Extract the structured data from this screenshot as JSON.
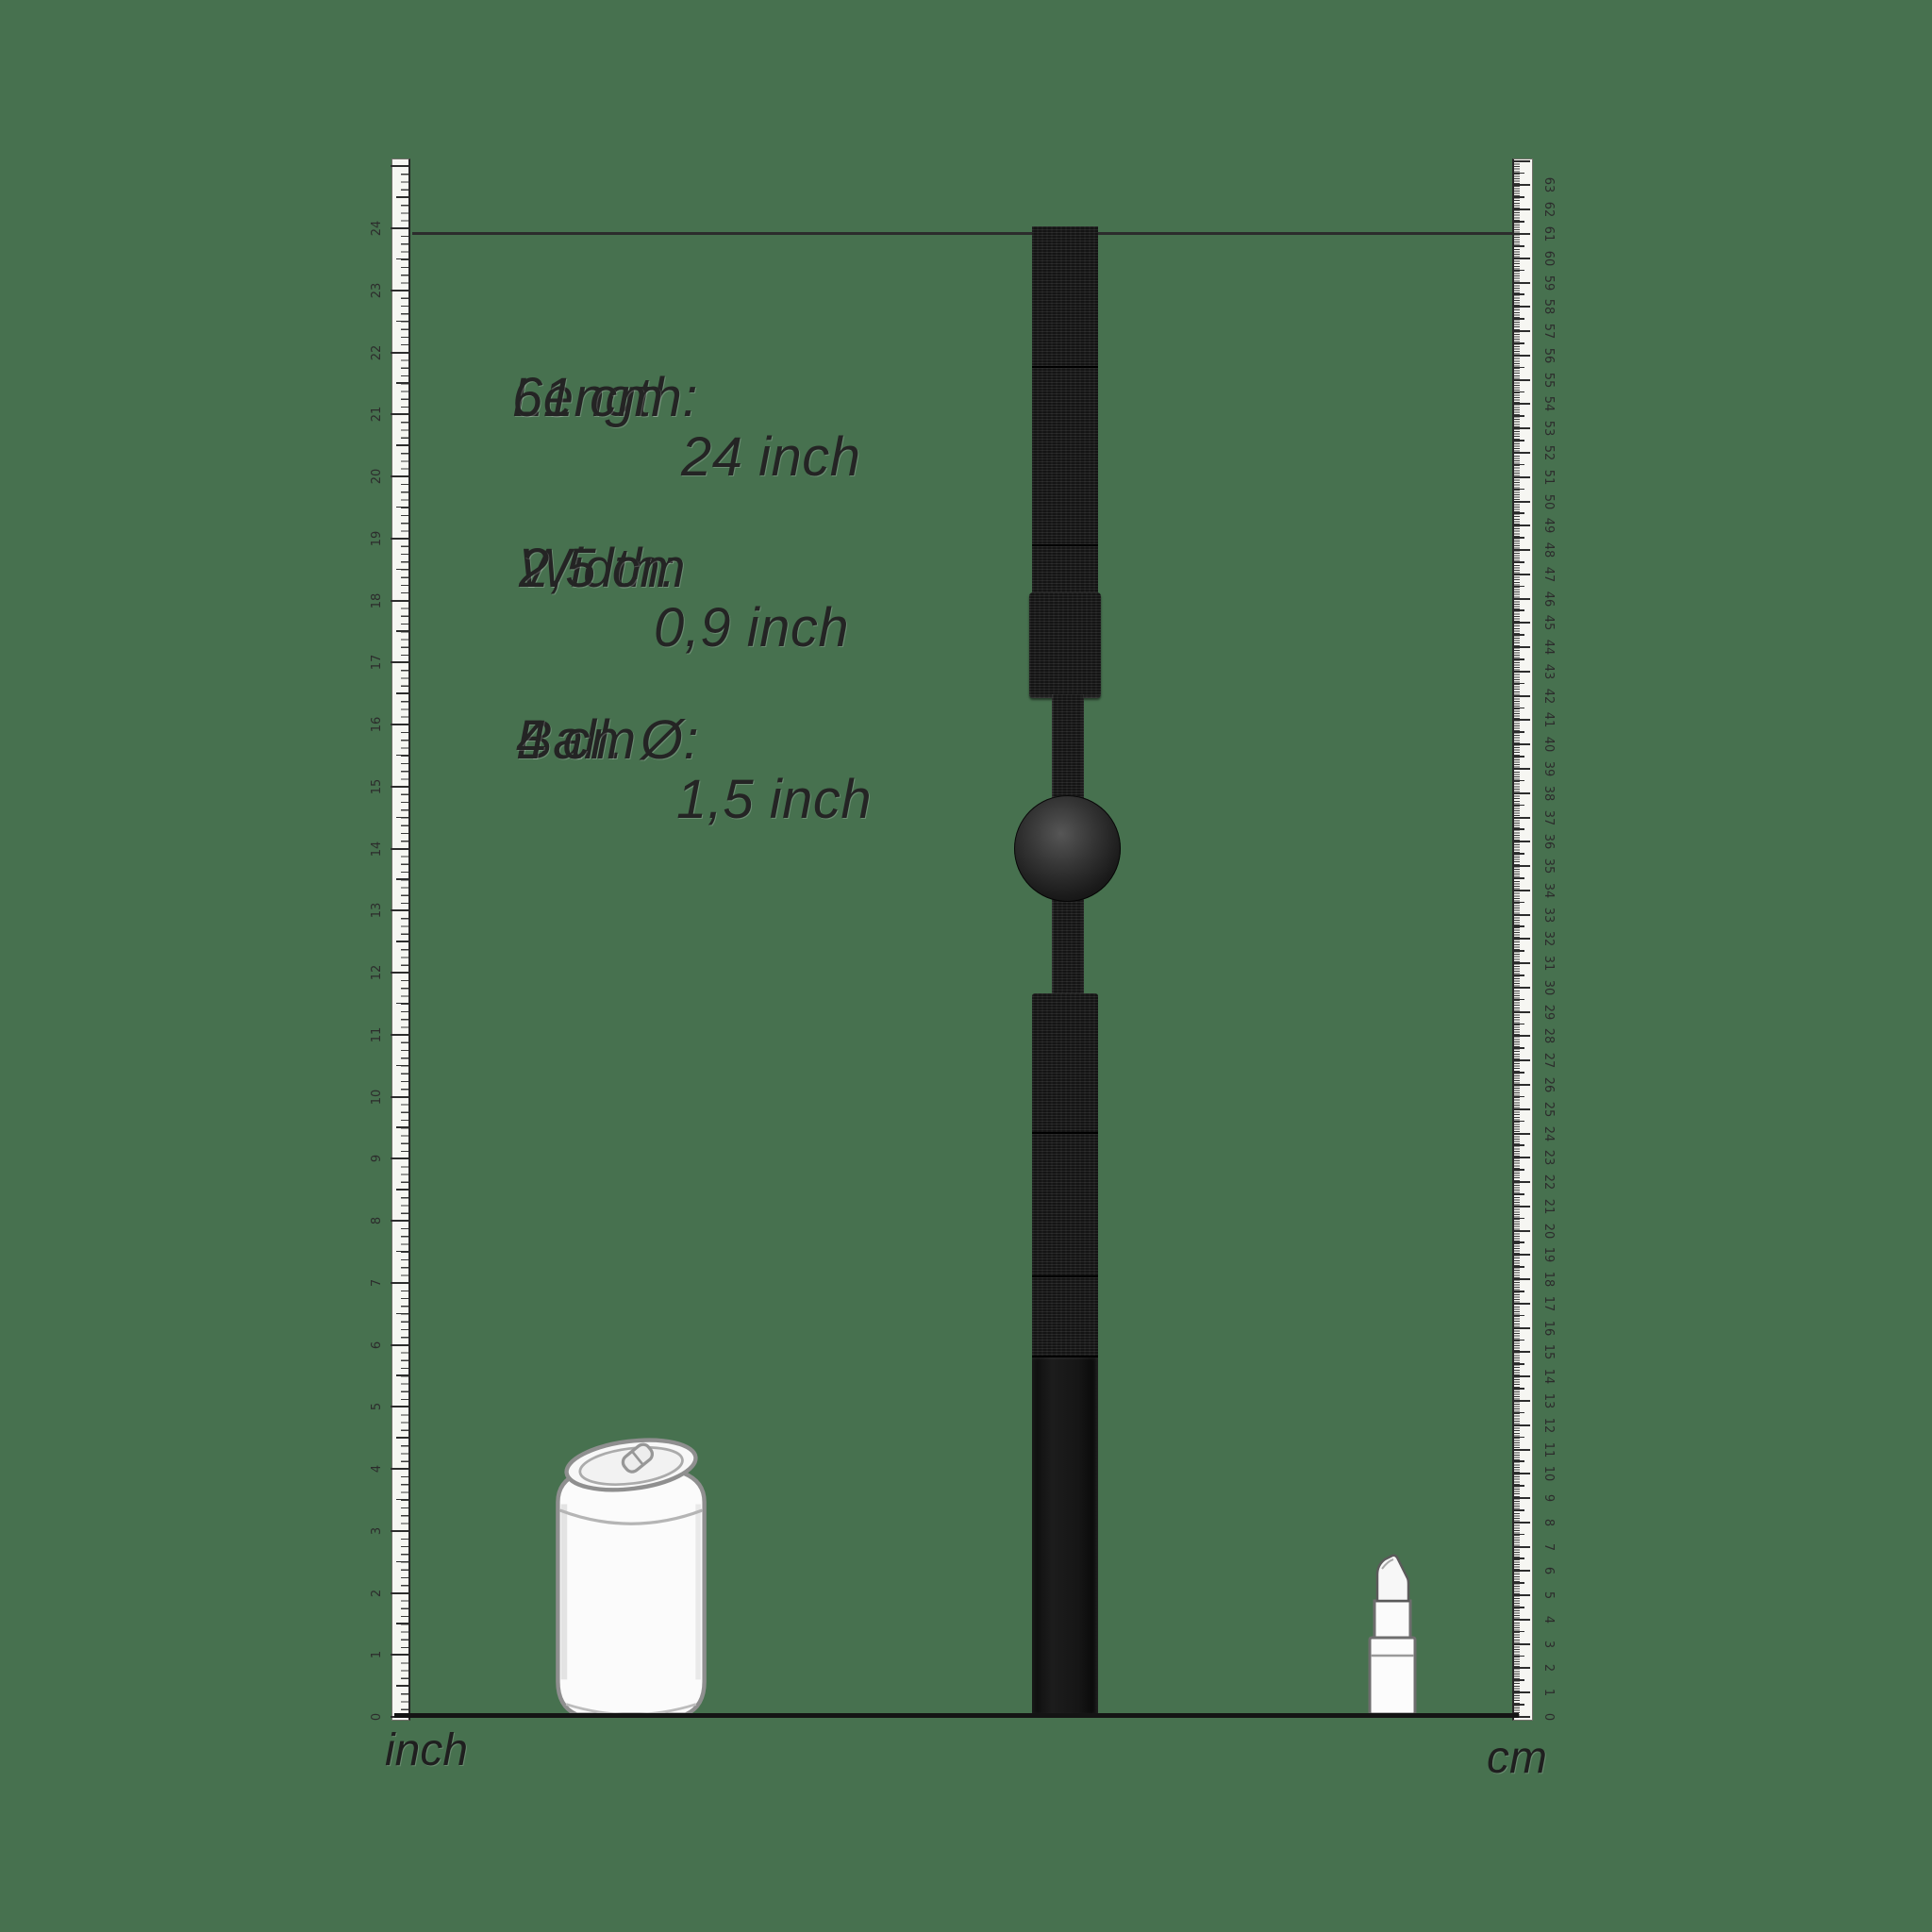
{
  "colors": {
    "background": "#47714F",
    "ink": "#242424",
    "tick": "#2d2d2d",
    "strap_black": "#141414",
    "reference_outline": "#8f8f8f"
  },
  "measurements": [
    {
      "label": "Length:",
      "metric": "61 cm",
      "imperial": "24 inch"
    },
    {
      "label": "Width:",
      "metric": "2,5 cm",
      "imperial": "0,9 inch"
    },
    {
      "label": "Ball. Ø:",
      "metric": "4 cm",
      "imperial": "1,5 inch"
    }
  ],
  "rulers": {
    "left": {
      "label": "inch",
      "min": 0,
      "max": 25,
      "numbered_min": 0,
      "numbered_max": 24
    },
    "right": {
      "label": "cm",
      "min": 0,
      "max": 64,
      "numbered_min": 0,
      "numbered_max": 63
    }
  },
  "objects": {
    "product": "ball-gag-with-straps",
    "references": [
      "soda-can",
      "lipstick"
    ]
  }
}
